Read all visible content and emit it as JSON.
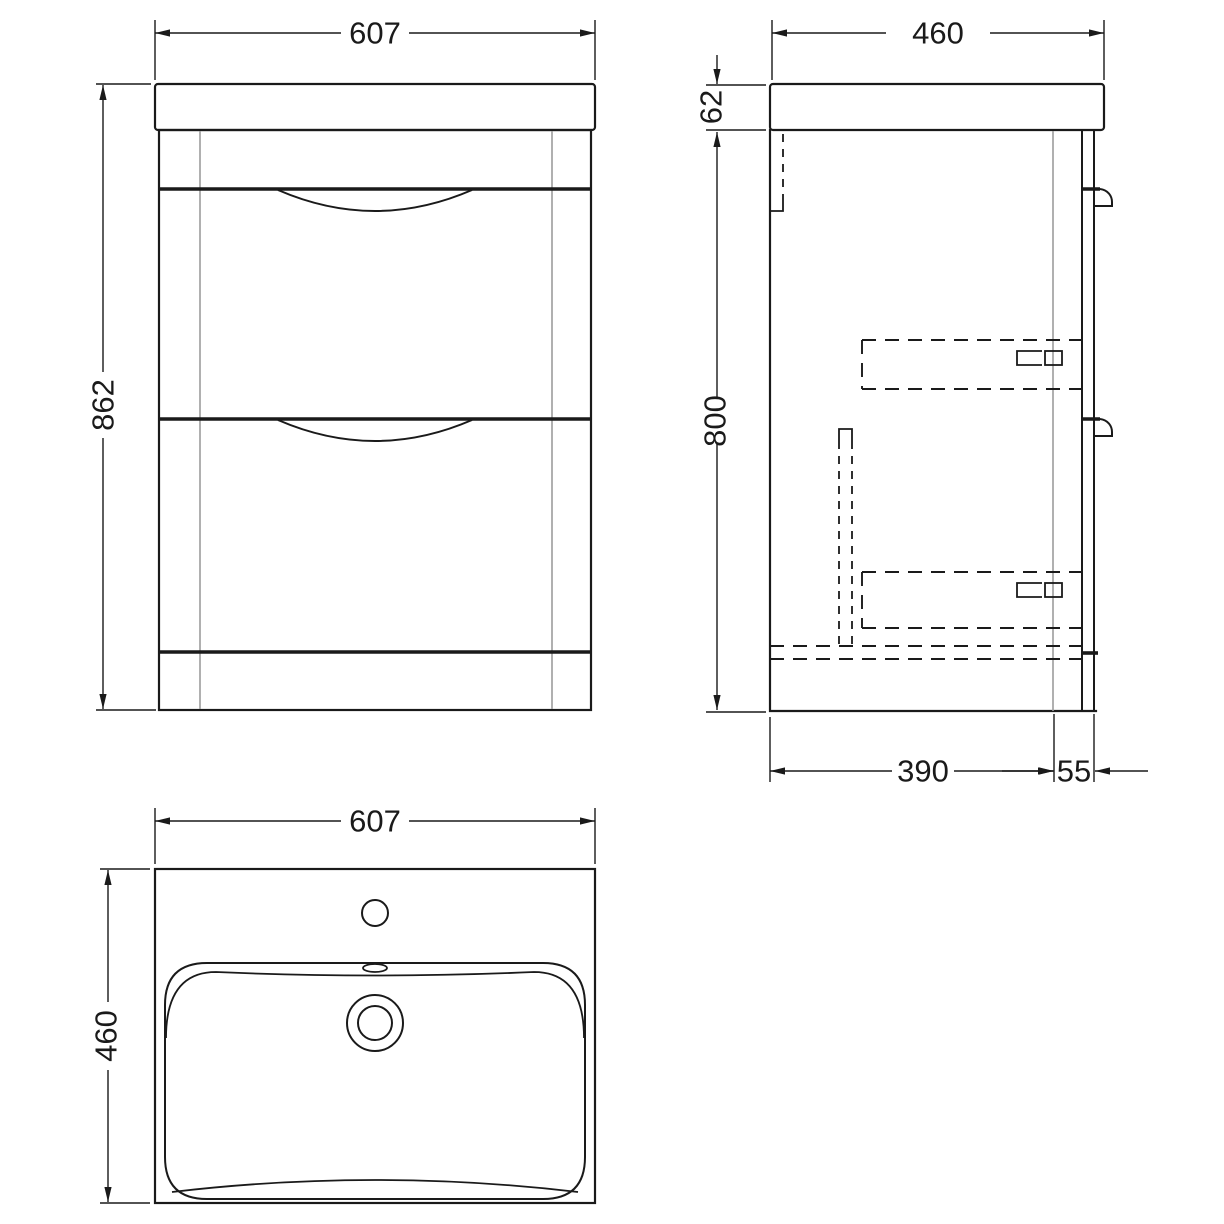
{
  "drawing": {
    "type": "vanity-unit-technical-drawing",
    "unit": "mm",
    "colors": {
      "line": "#1a1a1a",
      "secondary_line": "#9c9c9c",
      "background": "#ffffff"
    },
    "front_view": {
      "width": "607",
      "height": "862"
    },
    "side_view": {
      "depth": "460",
      "basin_top_thickness": "62",
      "cabinet_height": "800",
      "carcass_depth": "390",
      "front_overhang": "55"
    },
    "plan_view": {
      "width": "607",
      "depth": "460"
    }
  }
}
